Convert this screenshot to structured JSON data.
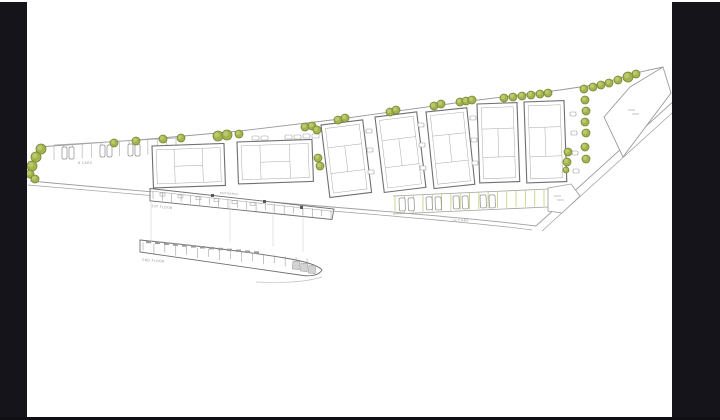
{
  "canvas": {
    "width": 720,
    "height": 420,
    "bg": "#ffffff",
    "side_bar_color": "#14141a",
    "bottom_line_color": "#101014"
  },
  "palette": {
    "outline": "#9a9a9a",
    "road": "#9f9f9f",
    "building": "#6f6f6f",
    "court_line": "#a8a8a8",
    "tree_fill": "#a4b44d",
    "tree_highlight": "#bcc96e",
    "tree_stroke": "#75863a",
    "stall_line_left": "#a9a9a9",
    "stall_line_right": "#c8d084",
    "text": "#9a9a9a",
    "dark_fill": "#5a5a5a",
    "hatch_fill": "#d2d2d2",
    "faint": "#cccccc"
  },
  "labels": {
    "first_floor": "1ST FLOOR",
    "second_floor": "2ND FLOOR",
    "left_parking": "8 CARS",
    "right_parking": "18 CARS",
    "entrance_road": "ENTRANCE"
  },
  "trees": [
    [
      41,
      149,
      5
    ],
    [
      36,
      157,
      5
    ],
    [
      32,
      166,
      5
    ],
    [
      30,
      174,
      4
    ],
    [
      35,
      179,
      4
    ],
    [
      114,
      143,
      4
    ],
    [
      136,
      141,
      4
    ],
    [
      163,
      139,
      4
    ],
    [
      181,
      138,
      4
    ],
    [
      218,
      136,
      5
    ],
    [
      227,
      135,
      5
    ],
    [
      239,
      134,
      4
    ],
    [
      305,
      127,
      4
    ],
    [
      312,
      126,
      4
    ],
    [
      317,
      130,
      4
    ],
    [
      318,
      158,
      4
    ],
    [
      320,
      166,
      4
    ],
    [
      338,
      120,
      4
    ],
    [
      345,
      118,
      4
    ],
    [
      390,
      112,
      4
    ],
    [
      396,
      110,
      4
    ],
    [
      434,
      106,
      4
    ],
    [
      441,
      104,
      4
    ],
    [
      460,
      102,
      4
    ],
    [
      466,
      101,
      4
    ],
    [
      472,
      100,
      4
    ],
    [
      504,
      98,
      4
    ],
    [
      513,
      97,
      4
    ],
    [
      522,
      96,
      4
    ],
    [
      531,
      95,
      4
    ],
    [
      540,
      94,
      4
    ],
    [
      548,
      93,
      4
    ],
    [
      584,
      89,
      4
    ],
    [
      593,
      87,
      4
    ],
    [
      601,
      85,
      4
    ],
    [
      609,
      83,
      4
    ],
    [
      618,
      80,
      4
    ],
    [
      628,
      77,
      5
    ],
    [
      636,
      74,
      4
    ],
    [
      585,
      100,
      4
    ],
    [
      586,
      111,
      4
    ],
    [
      585,
      122,
      4
    ],
    [
      586,
      133,
      4
    ],
    [
      585,
      147,
      4
    ],
    [
      586,
      159,
      4
    ],
    [
      568,
      152,
      4
    ],
    [
      567,
      162,
      4
    ],
    [
      566,
      170,
      3
    ]
  ],
  "courts": [
    {
      "x": 152,
      "y": 146,
      "w": 72,
      "h": 42,
      "rot": -2,
      "orient": "landscape"
    },
    {
      "x": 237,
      "y": 142,
      "w": 75,
      "h": 42,
      "rot": -2,
      "orient": "landscape"
    },
    {
      "x": 321,
      "y": 125,
      "w": 42,
      "h": 73,
      "rot": -7,
      "orient": "portrait"
    },
    {
      "x": 375,
      "y": 117,
      "w": 42,
      "h": 76,
      "rot": -7,
      "orient": "portrait"
    },
    {
      "x": 426,
      "y": 112,
      "w": 41,
      "h": 77,
      "rot": -6,
      "orient": "portrait"
    },
    {
      "x": 477,
      "y": 104,
      "w": 40,
      "h": 79,
      "rot": -2,
      "orient": "portrait"
    },
    {
      "x": 524,
      "y": 102,
      "w": 40,
      "h": 81,
      "rot": -2,
      "orient": "portrait"
    }
  ],
  "benches": [
    [
      366,
      129
    ],
    [
      367,
      148
    ],
    [
      368,
      170
    ],
    [
      418,
      123
    ],
    [
      419,
      143
    ],
    [
      420,
      166
    ],
    [
      470,
      116
    ],
    [
      471,
      138
    ],
    [
      472,
      161
    ],
    [
      570,
      112
    ],
    [
      571,
      131
    ],
    [
      572,
      151
    ],
    [
      573,
      169
    ]
  ],
  "path_rects": [
    [
      252,
      136
    ],
    [
      261,
      136
    ],
    [
      285,
      135
    ],
    [
      294,
      135
    ],
    [
      303,
      134
    ],
    [
      312,
      134
    ]
  ],
  "left_lot": {
    "rail": [
      54,
      145,
      176,
      138
    ],
    "n": 14,
    "len": 15,
    "cars": [
      [
        62,
        147
      ],
      [
        69,
        147
      ],
      [
        100,
        145
      ],
      [
        107,
        145
      ],
      [
        128,
        144
      ],
      [
        135,
        144
      ]
    ]
  },
  "right_lot": {
    "top": [
      393,
      196,
      548,
      189
    ],
    "bottom": [
      393,
      214,
      548,
      207
    ],
    "n": 17,
    "len": 17,
    "cars": [
      [
        399,
        198
      ],
      [
        408,
        198
      ],
      [
        426,
        197
      ],
      [
        435,
        197
      ],
      [
        453,
        196
      ],
      [
        462,
        196
      ],
      [
        480,
        195
      ],
      [
        489,
        195
      ]
    ]
  },
  "dark_squares": [
    [
      211,
      194
    ],
    [
      263,
      200
    ],
    [
      300,
      206
    ]
  ],
  "strips": {
    "first": {
      "x0": 153,
      "x1": 331,
      "ytop0": 190.8,
      "ytop1": 209.4,
      "n": 20,
      "toprects": [
        160,
        178,
        196,
        214,
        232,
        250
      ]
    },
    "second": {
      "x0": 143,
      "x1": 307,
      "ytop0": 241.5,
      "ytop1": 257.5,
      "n": 16,
      "dashes": 13
    }
  },
  "hatch_rects": [
    [
      293,
      261
    ],
    [
      301,
      263
    ],
    [
      309,
      265
    ]
  ],
  "projection_lines": [
    [
      151,
      202,
      151,
      240
    ],
    [
      230,
      199,
      230,
      242
    ],
    [
      273,
      204,
      273,
      247
    ],
    [
      303,
      208,
      303,
      252
    ]
  ],
  "micro_dashes": [
    [
      554,
      196
    ],
    [
      557,
      200
    ],
    [
      628,
      110
    ],
    [
      632,
      114
    ]
  ]
}
